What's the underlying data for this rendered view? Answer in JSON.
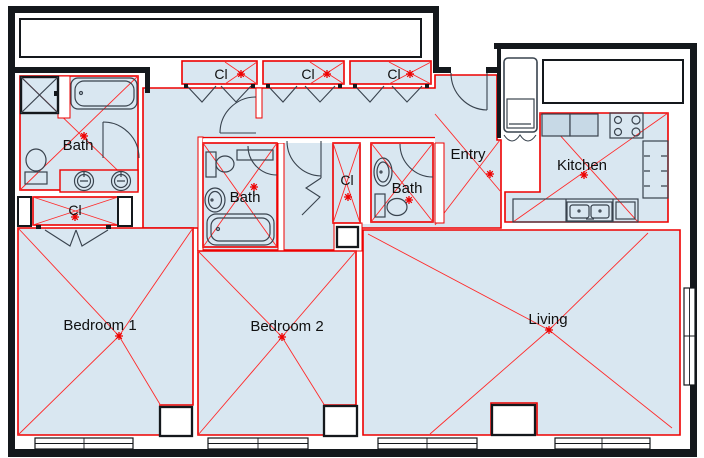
{
  "title": "Apartment floor plan",
  "colors": {
    "room_fill": "#d9e7f1",
    "zone_boundary": "#ee0000",
    "zone_x_lines": "#ff2a2a",
    "walls": "#14181c",
    "fixtures": "#39434e",
    "marker": "#ee0000"
  },
  "rooms": [
    {
      "id": "bath-main",
      "label": "Bath"
    },
    {
      "id": "closet-main",
      "label": "Cl"
    },
    {
      "id": "closet-hall-1",
      "label": "Cl"
    },
    {
      "id": "closet-hall-2",
      "label": "Cl"
    },
    {
      "id": "closet-hall-3",
      "label": "Cl"
    },
    {
      "id": "bath-2",
      "label": "Bath"
    },
    {
      "id": "closet-bedroom-2",
      "label": "Cl"
    },
    {
      "id": "bath-3",
      "label": "Bath"
    },
    {
      "id": "entry",
      "label": "Entry"
    },
    {
      "id": "kitchen",
      "label": "Kitchen"
    },
    {
      "id": "bedroom-1",
      "label": "Bedroom 1"
    },
    {
      "id": "bedroom-2",
      "label": "Bedroom 2"
    },
    {
      "id": "living",
      "label": "Living"
    }
  ]
}
